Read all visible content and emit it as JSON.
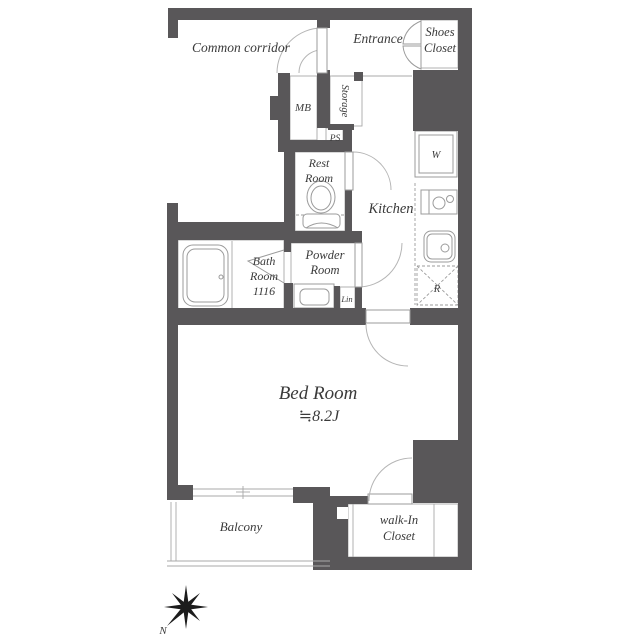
{
  "labels": {
    "common_corridor": "Common corridor",
    "entrance": "Entrance",
    "shoes_closet": {
      "line1": "Shoes",
      "line2": "Closet"
    },
    "mb": "MB",
    "storage": "Storage",
    "ps": "PS",
    "rest_room": {
      "line1": "Rest",
      "line2": "Room"
    },
    "kitchen": "Kitchen",
    "washer": "W",
    "bath_room": {
      "line1": "Bath",
      "line2": "Room",
      "line3": "1116"
    },
    "powder_room": {
      "line1": "Powder",
      "line2": "Room"
    },
    "linen": "Lin",
    "refrigerator": "R",
    "bed_room": {
      "name": "Bed Room",
      "size": "≒8.2J"
    },
    "balcony": "Balcony",
    "walk_in_closet": {
      "line1": "walk-In",
      "line2": "Closet"
    },
    "compass_north": "N"
  },
  "colors": {
    "wall": "#595759",
    "line": "#a9a9a9",
    "fixture": "#9b9b9b",
    "door": "#b5b5b5",
    "text": "#3a3a3a",
    "star": "#1c1c1c"
  }
}
